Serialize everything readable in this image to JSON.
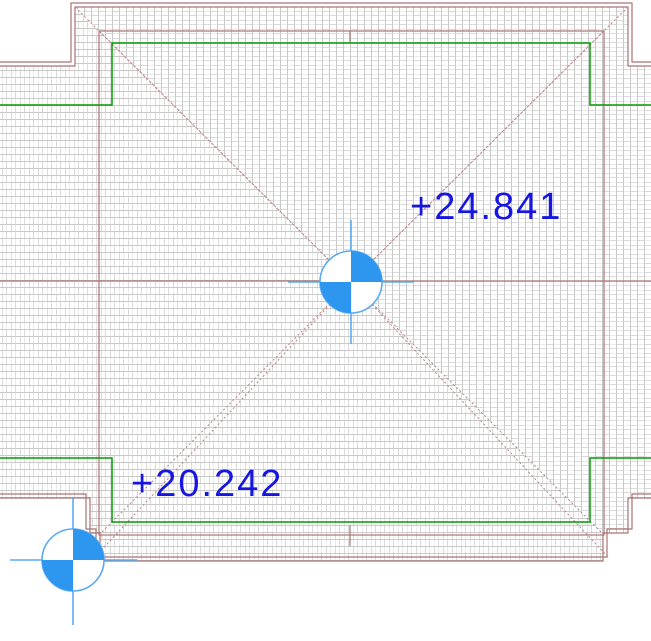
{
  "canvas": {
    "width": 651,
    "height": 641,
    "background": "#ffffff",
    "description": "Roof plan view with hip lines, surface hatch, and spot elevation annotations"
  },
  "annotations": {
    "upper_spot_elevation": {
      "label": "+24.841"
    },
    "lower_spot_elevation": {
      "label": "+20.242"
    }
  },
  "colors": {
    "text_blue": "#1616e0",
    "symbol_blue": "#2d96ee",
    "crosshair_blue": "#5aabf5",
    "roof_line_brown": "#ab7373",
    "hip_dotted_brown": "#b98585",
    "plan_green": "#009a00",
    "hatch_gray": "#c9c9c9"
  }
}
